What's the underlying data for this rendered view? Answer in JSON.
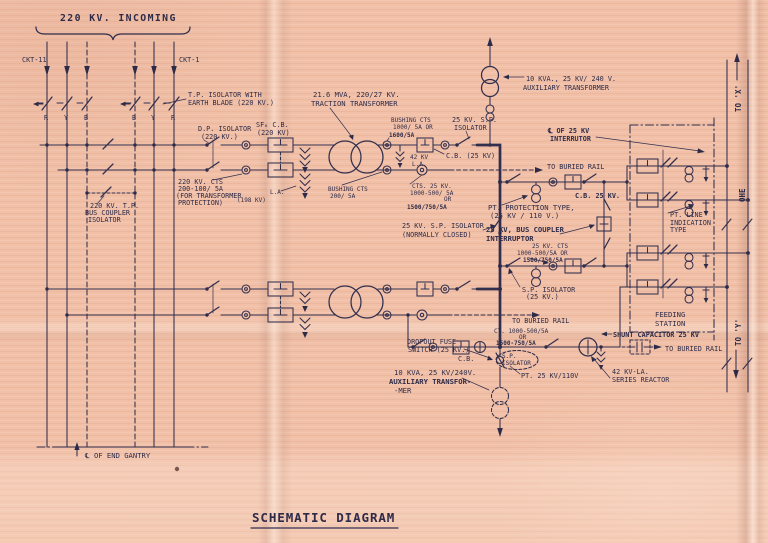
{
  "page_title": "SCHEMATIC DIAGRAM",
  "heading_220kv": "220 KV. INCOMING",
  "circuits": {
    "left": "CKT-11",
    "right": "CKT-1"
  },
  "phases_ckt11": [
    "R",
    "Y",
    "B"
  ],
  "phases_ckt1": [
    "B",
    "Y",
    "R"
  ],
  "labels": {
    "tp_isolator": [
      "T.P. ISOLATOR WITH",
      "EARTH BLADE (220 KV.)"
    ],
    "dp_isolator": [
      "D.P. ISOLATOR",
      "(220 KV.)"
    ],
    "sf6_cb": [
      "SF₆ C.B.",
      "(220 KV)"
    ],
    "traction_tx": [
      "21.6 MVA, 220/27 KV.",
      "TRACTION TRANSFORMER"
    ],
    "bushing_cts_hv": [
      "BUSHING CTS",
      "1000/ 5A OR",
      "1600/5A"
    ],
    "sp_isolator_top": [
      "25 KV. S.P.",
      "ISOLATOR"
    ],
    "la_42kv_top": [
      "42 KV",
      "L.A."
    ],
    "cb_25kv_branch": "C.B. (25 KV)",
    "cts_25kv_top": [
      "CTS. 25 KV.",
      "1000-500/ 5A",
      "OR",
      "1500/750/5A"
    ],
    "tp_bus_coupler": [
      "220 KV. T.P.",
      "BUS COUPLER",
      "ISOLATOR"
    ],
    "cts_220kv": [
      "220 KV. CTS",
      "200-100/ 5A",
      "(FOR TRANSFORMER",
      "PROTECTION)"
    ],
    "la_198kv": [
      "L.A.",
      "(198 KV)"
    ],
    "bushing_cts_lv": [
      "BUSHING CTS",
      "200/ 5A"
    ],
    "aux_tx_top": [
      "10 KVA., 25 KV/ 240 V.",
      "AUXILIARY TRANSFORMER"
    ],
    "cl_25kv_interruptor": [
      "℄ OF 25 KV",
      "INTERRUTOR"
    ],
    "to_buried_rail_1": "TO BURIED RAIL",
    "cb_25kv": "C.B. 25 KV.",
    "pt_protection": [
      "PT. PROTECTION TYPE,",
      "(25 KV / 110 V.)"
    ],
    "bus_coupler_25kv": [
      "25 KV, BUS COUPLER",
      "INTERRUPTOR"
    ],
    "cts_25kv_mid": [
      "25 KV. CTS",
      "1000-500/5A OR",
      "1500/750/5A"
    ],
    "sp_isolator_nc": [
      "25 KV. S.P. ISOLATOR",
      "(NORMALLY CLOSED)"
    ],
    "sp_isolator_25kv": [
      "S.P. ISOLATOR",
      "(25 KV.)"
    ],
    "to_buried_rail_2": "TO BURIED RAIL",
    "pt_line_indication": [
      "PT. LINE",
      "INDICATION",
      "TYPE"
    ],
    "feeding_station": [
      "FEEDING",
      "STATION"
    ],
    "ct_bottom": [
      "CT. 1000-500/5A",
      "OR",
      "1500-750/5A"
    ],
    "dropout_fuse": [
      "DROPOUT FUSE",
      "SWITCH (25 KV.)"
    ],
    "sp_isolator_small": [
      "S.P.",
      "ISOLATOR"
    ],
    "cb_small": "C.B.",
    "pt_25kv_110v": "PT. 25 KV/110V",
    "aux_tx_bottom": [
      "10 KVA, 25 KV/240V.",
      "AUXILIARY  TRANSFOR-",
      "-MER"
    ],
    "shunt_capacitor": "SHUNT CAPACITOR 25 KV",
    "to_buried_rail_3": "TO BURIED RAIL",
    "la_42kv_bottom": "42 KV-LA.",
    "series_reactor": "SERIES REACTOR",
    "end_gantry": "℄ OF END GANTRY",
    "to_x": "TO 'X'",
    "to_y": "TO 'Y'",
    "ohe": "OHE"
  },
  "colors": {
    "paper": "#f1c0a7",
    "ink": "#2e2b49"
  }
}
